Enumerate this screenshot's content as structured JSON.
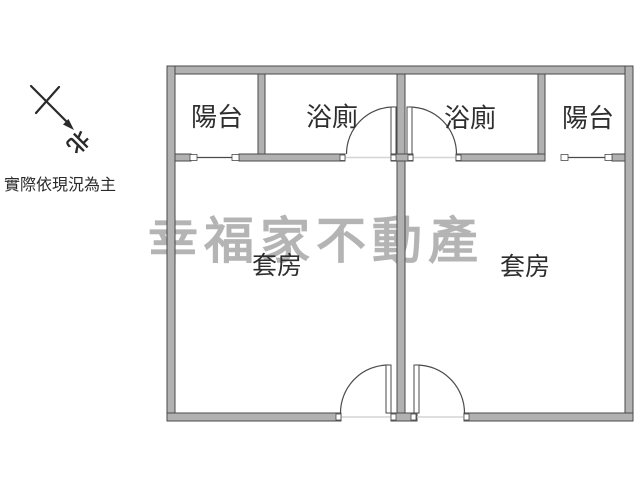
{
  "title": "apartment-floor-plan",
  "compass": {
    "north_label": "北"
  },
  "disclaimer": {
    "text": "實際依現況為主"
  },
  "watermark": {
    "text": "幸福家不動產",
    "color": "#b4b4b4"
  },
  "colors": {
    "background": "#ffffff",
    "wall_fill": "#b1b1b1",
    "wall_stroke": "#4a4a4a",
    "label": "#2e2e2e",
    "watermark": "#b4b4b4"
  },
  "floorplan": {
    "rooms": [
      {
        "id": "balcony-left",
        "label": "陽台"
      },
      {
        "id": "bathroom-left",
        "label": "浴廁"
      },
      {
        "id": "bathroom-right",
        "label": "浴廁"
      },
      {
        "id": "balcony-right",
        "label": "陽台"
      },
      {
        "id": "suite-left",
        "label": "套房"
      },
      {
        "id": "suite-right",
        "label": "套房"
      }
    ]
  }
}
